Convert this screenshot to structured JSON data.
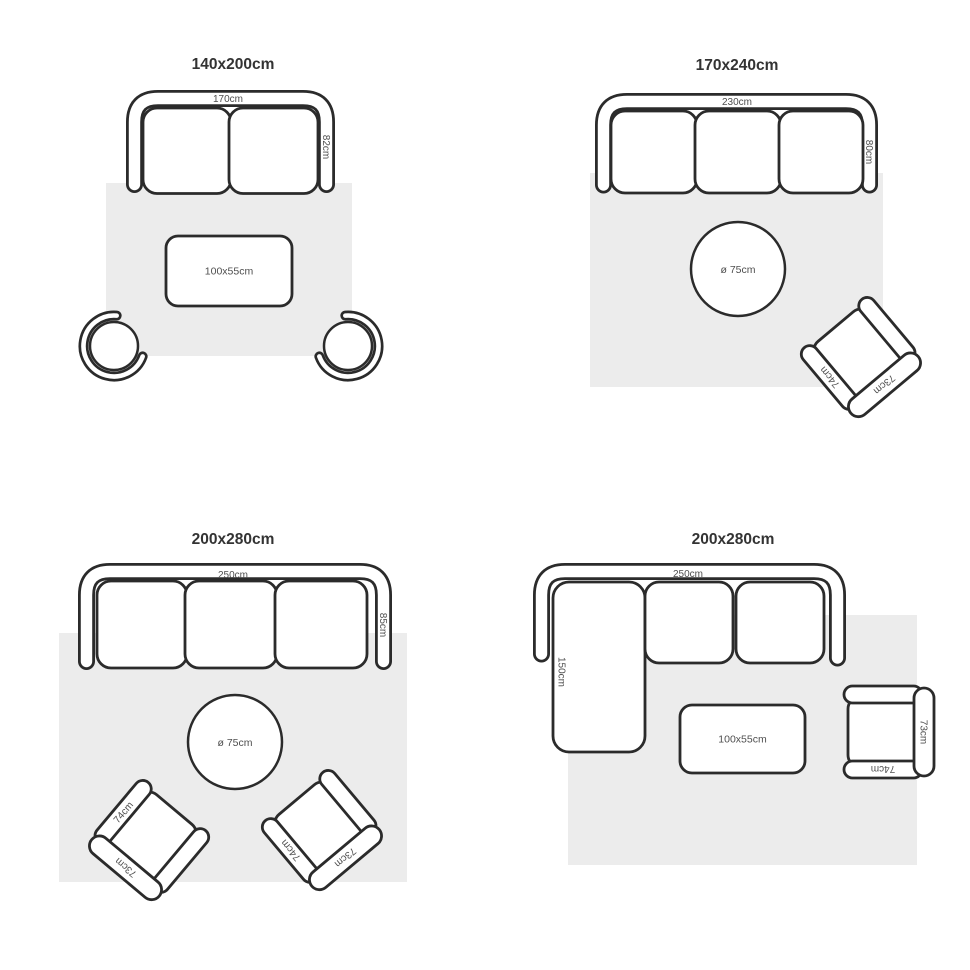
{
  "colors": {
    "background": "#ffffff",
    "outline": "#2b2b2b",
    "rug": "#ececec",
    "label": "#4f4f4f",
    "title": "#333333"
  },
  "chair": {
    "arm_label": "74cm",
    "back_label": "73cm"
  },
  "quadrants": [
    {
      "title": "140x200cm",
      "sofa_width": "170cm",
      "sofa_depth": "82cm",
      "table_label": "100x55cm"
    },
    {
      "title": "170x240cm",
      "sofa_width": "230cm",
      "sofa_depth": "80cm",
      "table_label": "ø 75cm"
    },
    {
      "title": "200x280cm",
      "sofa_width": "250cm",
      "sofa_depth": "85cm",
      "table_label": "ø 75cm"
    },
    {
      "title": "200x280cm",
      "sofa_width": "250cm",
      "chaise_length": "150cm",
      "table_label": "100x55cm"
    }
  ]
}
